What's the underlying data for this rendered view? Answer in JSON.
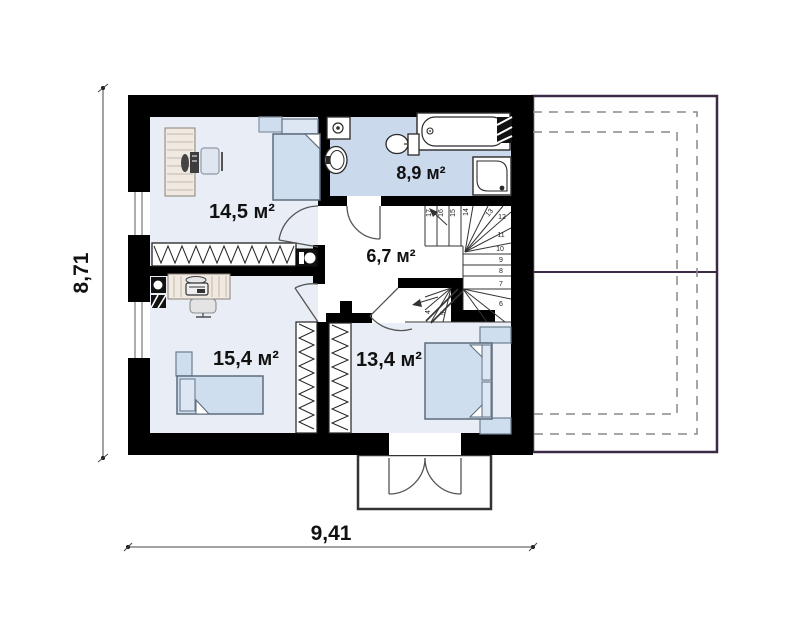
{
  "plan": {
    "type": "floor-plan",
    "floor": "attic / second floor",
    "rooms": [
      {
        "id": "room-top-left",
        "area_label": "14,5 м²"
      },
      {
        "id": "bathroom",
        "area_label": "8,9 м²"
      },
      {
        "id": "hall",
        "area_label": "6,7 м²"
      },
      {
        "id": "room-bottom-left",
        "area_label": "15,4 м²"
      },
      {
        "id": "room-bottom-right",
        "area_label": "13,4 м²"
      }
    ],
    "dimensions": {
      "overall_width_label": "9,41",
      "overall_height_label": "8,71"
    },
    "stairs": {
      "steps": [
        "4",
        "5",
        "6",
        "7",
        "8",
        "9",
        "10",
        "11",
        "12",
        "13",
        "14",
        "15",
        "16",
        "17"
      ]
    },
    "colors": {
      "wall": "#000000",
      "room_floor": "#e9eef6",
      "bathroom_floor": "#cbd9ed",
      "furniture_fill": "#cfdeee",
      "furniture_stroke": "#6e7d8f",
      "fixture_stroke": "#2a2a2a",
      "annex_outline": "#3b2a45",
      "roof_dashed": "#888888",
      "dimension_line": "#444444"
    }
  }
}
